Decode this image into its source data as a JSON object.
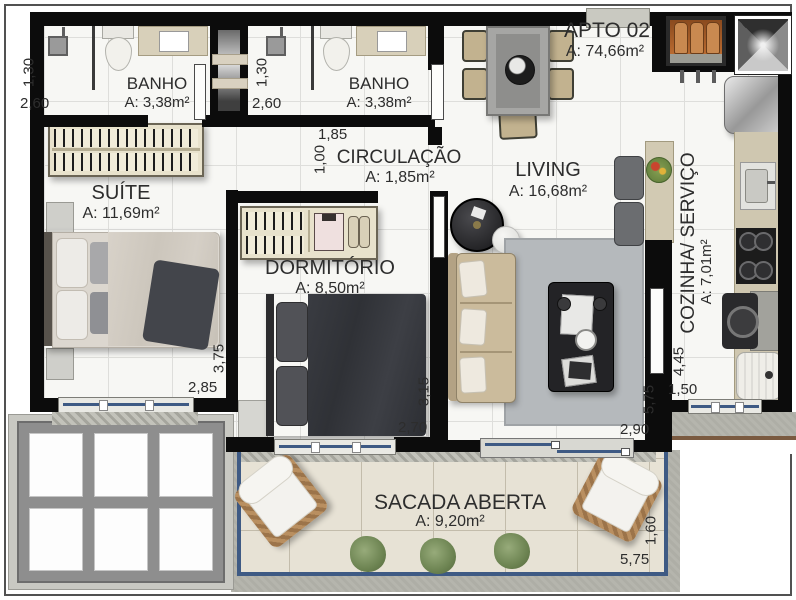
{
  "plan": {
    "apto": {
      "label": "APTO 02",
      "area": "A: 74,66m²"
    },
    "rooms": {
      "banho1": {
        "name": "BANHO",
        "area": "A: 3,38m²"
      },
      "banho2": {
        "name": "BANHO",
        "area": "A: 3,38m²"
      },
      "circulacao": {
        "name": "CIRCULAÇÃO",
        "area": "A: 1,85m²"
      },
      "suite": {
        "name": "SUÍTE",
        "area": "A: 11,69m²"
      },
      "dormitorio": {
        "name": "DORMITÓRIO",
        "area": "A: 8,50m²"
      },
      "living": {
        "name": "LIVING",
        "area": "A: 16,68m²"
      },
      "cozinha": {
        "name": "COZINHA/ SERVIÇO",
        "area": "A: 7,01m²"
      },
      "sacada": {
        "name": "SACADA ABERTA",
        "area": "A: 9,20m²"
      }
    },
    "dimensions": {
      "banho1_w": "2,60",
      "banho1_h": "1,30",
      "banho2_w": "2,60",
      "banho2_h": "1,30",
      "circulacao_w": "1,85",
      "circulacao_h": "1,00",
      "suite_w": "2,85",
      "suite_h": "3,75",
      "dormitorio_w": "2,70",
      "dormitorio_h": "3,15",
      "living_w": "2,90",
      "living_h": "5,75",
      "cozinha_w": "1,50",
      "cozinha_h": "4,45",
      "sacada_w": "5,75",
      "sacada_h": "1,60"
    },
    "colors": {
      "wall": "#0c0c0c",
      "glass": "#3e5a84",
      "balcony_border": "#3e5a84",
      "floor": "#f7f7f4",
      "balcony_floor": "#e7e2d5",
      "concrete": "#b3b3ab",
      "gas_orange": "#b5651f",
      "text": "#2d2d2d"
    }
  }
}
